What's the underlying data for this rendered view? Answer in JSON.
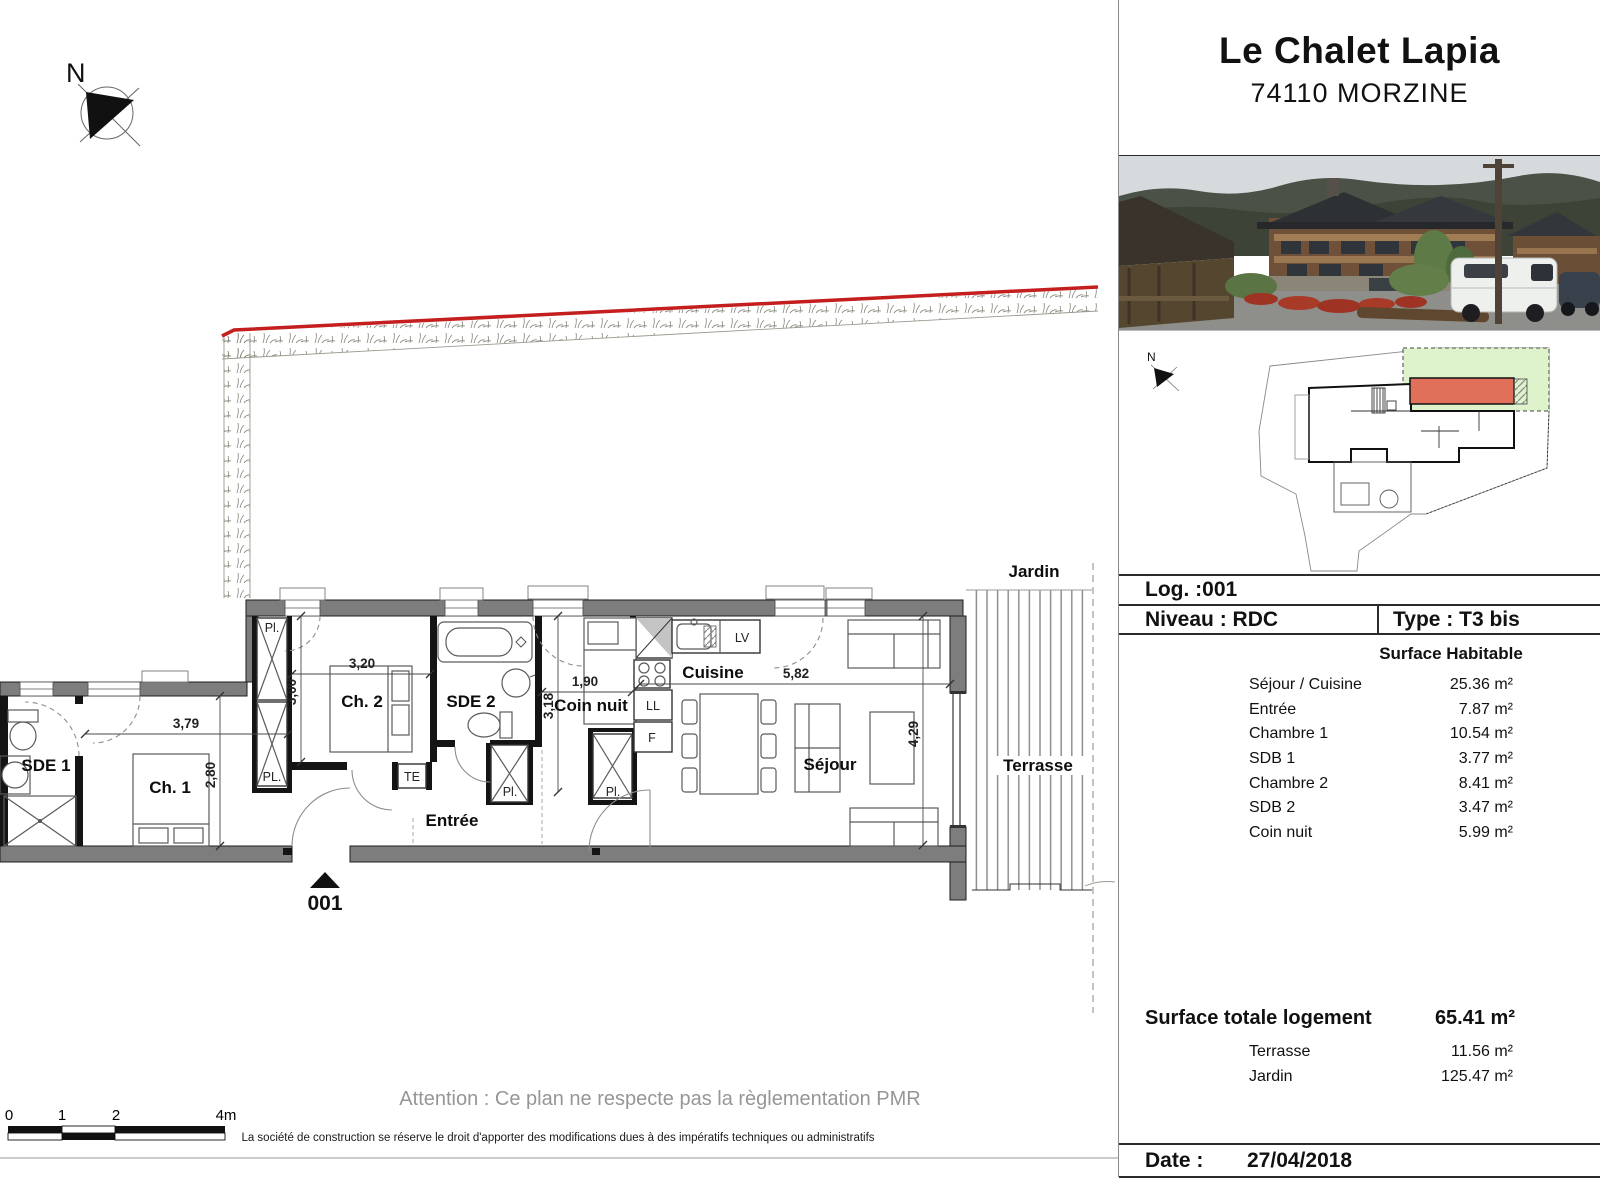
{
  "colors": {
    "red_line": "#c41e1e",
    "unit_highlight": "#e0705a",
    "jardin_green": "#def2cc",
    "wall_gray": "#7d7d7d"
  },
  "plan": {
    "north_label": "N",
    "sitemap_north": "N",
    "rooms": {
      "sde1": "SDE 1",
      "ch1": "Ch. 1",
      "ch2": "Ch. 2",
      "sde2": "SDE 2",
      "coin_nuit": "Coin nuit",
      "cuisine": "Cuisine",
      "sejour": "Séjour",
      "entree": "Entrée",
      "terrasse": "Terrasse",
      "jardin": "Jardin"
    },
    "fixtures": {
      "pl_top": "Pl.",
      "pl_bottom": "PL.",
      "pl_entree": "Pl.",
      "pl_coin": "Pl.",
      "te": "TE",
      "lv": "LV",
      "ll": "LL",
      "f": "F"
    },
    "dims": {
      "ch1_w": "3,79",
      "ch1_h": "2,80",
      "ch2_w": "3,20",
      "ch2_h": "3,00",
      "coin_w": "1,90",
      "coin_h": "3,18",
      "sejour_w": "5,82",
      "sejour_h": "4,29"
    },
    "entrance_number": "001",
    "scale": {
      "t0": "0",
      "t1": "1",
      "t2": "2",
      "t4": "4m"
    }
  },
  "footer": {
    "attention": "Attention : Ce plan ne respecte pas la règlementation PMR",
    "disclaimer": "La société de construction se réserve le droit d'apporter des modifications dues à des impératifs techniques ou administratifs"
  },
  "panel": {
    "title": "Le Chalet Lapia",
    "subtitle": "74110 MORZINE",
    "log_label": "Log. :001",
    "niveau_label": "Niveau : RDC",
    "type_label": "Type : T3 bis",
    "surface_header": "Surface Habitable",
    "rooms": [
      {
        "label": "Séjour / Cuisine",
        "value": "25.36 m²"
      },
      {
        "label": "Entrée",
        "value": "7.87 m²"
      },
      {
        "label": "Chambre 1",
        "value": "10.54 m²"
      },
      {
        "label": "SDB 1",
        "value": "3.77 m²"
      },
      {
        "label": "Chambre 2",
        "value": "8.41 m²"
      },
      {
        "label": "SDB 2",
        "value": "3.47 m²"
      },
      {
        "label": "Coin nuit",
        "value": "5.99 m²"
      }
    ],
    "total_label": "Surface totale logement",
    "total_value": "65.41 m²",
    "extras": [
      {
        "label": "Terrasse",
        "value": "11.56 m²"
      },
      {
        "label": "Jardin",
        "value": "125.47 m²"
      }
    ],
    "date_label": "Date :",
    "date_value": "27/04/2018"
  }
}
